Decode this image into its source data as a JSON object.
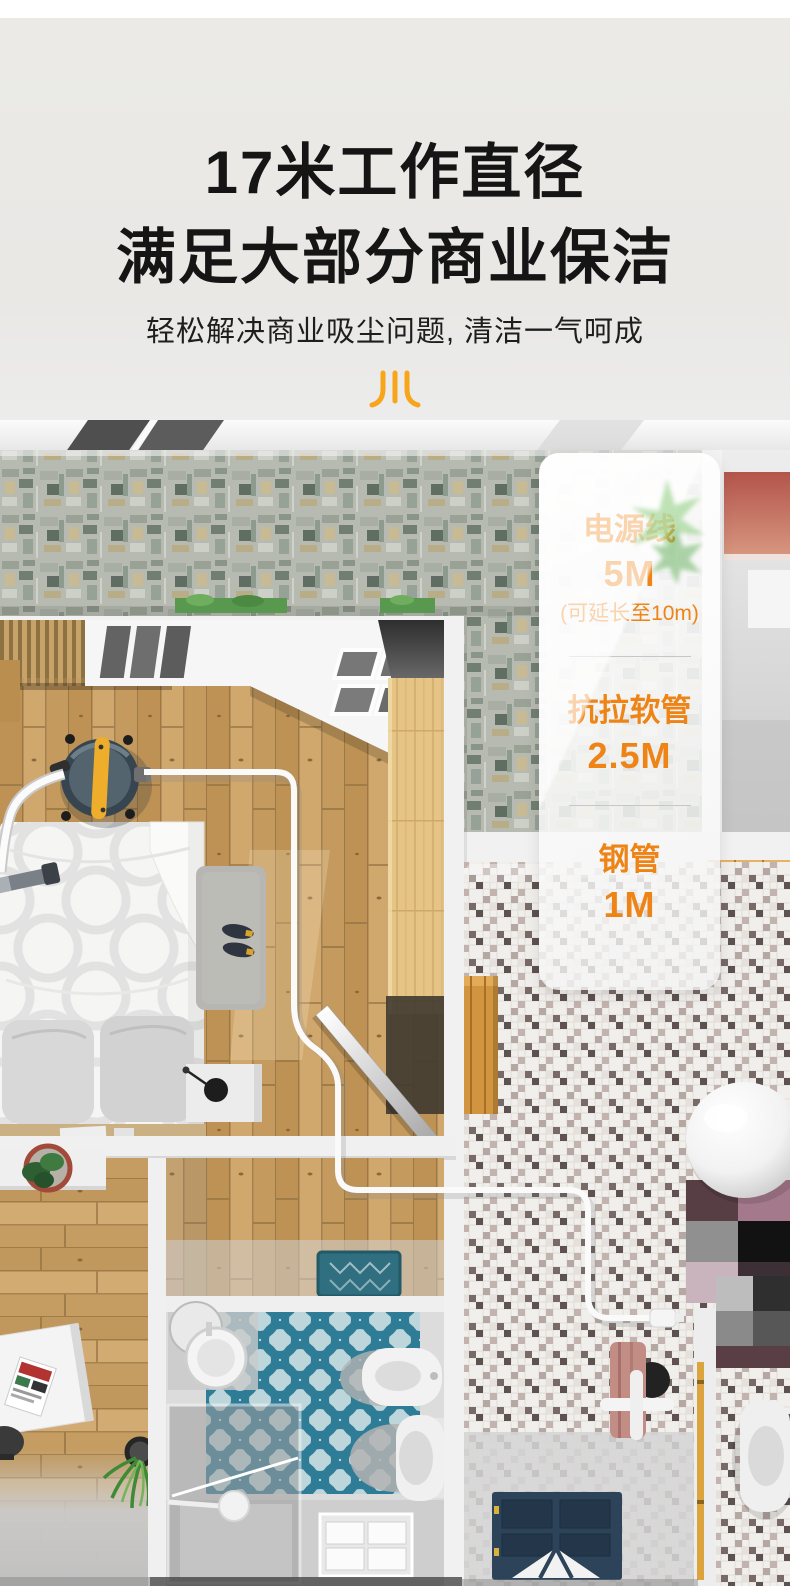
{
  "page": {
    "background_color": "#e9e8e5",
    "accent_orange": "#ee8316",
    "logo_orange": "#f7a61b"
  },
  "header": {
    "title_line1": "17米工作直径",
    "title_line2": "满足大部分商业保洁",
    "subtitle": "轻松解决商业吸尘问题, 清洁一气呵成",
    "logo_icon": "chuan-brand-icon"
  },
  "specs_panel": {
    "items": [
      {
        "label": "电源线",
        "value": "5M",
        "note": "(可延长至10m)"
      },
      {
        "label": "抗拉软管",
        "value": "2.5M",
        "note": ""
      },
      {
        "label": "钢管",
        "value": "1M",
        "note": ""
      }
    ]
  },
  "floorplan": {
    "alt": "俯视公寓三维渲染：吸尘器位于卧室，电源线经走廊延伸至卫生间墙面插座"
  }
}
